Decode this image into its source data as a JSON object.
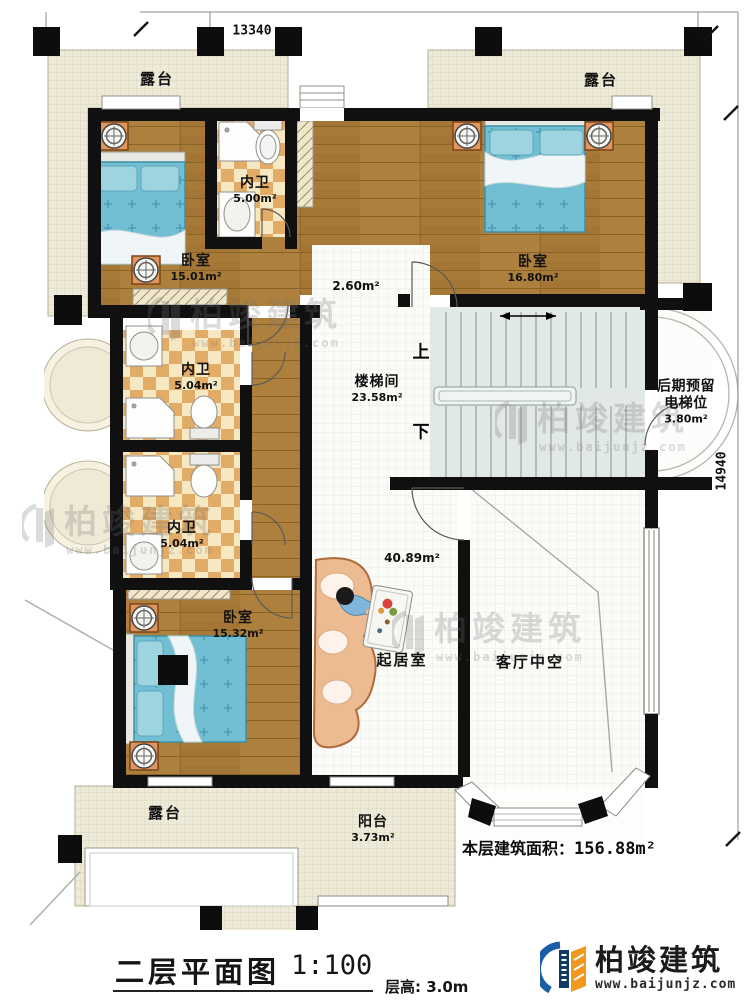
{
  "dimensions": {
    "top": "13340",
    "right": "14940"
  },
  "rooms": {
    "terrace_tl": {
      "label": "露台"
    },
    "terrace_tr": {
      "label": "露台"
    },
    "terrace_bl": {
      "label": "露台"
    },
    "balcony": {
      "label": "阳台",
      "area": "3.73m²"
    },
    "bath_top": {
      "label": "内卫",
      "area": "5.00m²"
    },
    "bath_mid": {
      "label": "内卫",
      "area": "5.04m²"
    },
    "bath_low": {
      "label": "内卫",
      "area": "5.04m²"
    },
    "bedroom_tl": {
      "label": "卧室",
      "area": "15.01m²"
    },
    "bedroom_tr": {
      "label": "卧室",
      "area": "16.80m²"
    },
    "bedroom_bl": {
      "label": "卧室",
      "area": "15.32m²"
    },
    "hall": {
      "area": "2.60m²"
    },
    "stairwell": {
      "label": "楼梯间",
      "area": "23.58m²"
    },
    "elevator": {
      "label_line1": "后期预留",
      "label_line2": "电梯位",
      "area": "3.80m²"
    },
    "living": {
      "label": "起居室",
      "area": "40.89m²"
    },
    "void": {
      "label": "客厅中空"
    }
  },
  "stairs": {
    "up": "上",
    "down": "下"
  },
  "area_note": {
    "label": "本层建筑面积：",
    "value": "156.88m²"
  },
  "title_block": {
    "title": "二层平面图",
    "scale": "1:100",
    "floor_height": "层高: 3.0m"
  },
  "logo": {
    "name": "柏竣建筑",
    "website": "www.baijunjz.com"
  },
  "watermark": {
    "text": "柏竣建筑",
    "url": "www.baijunjz.com"
  },
  "colors": {
    "wall": "#111111",
    "wood": "#a87a37",
    "terrace": "#edead9",
    "checker": "#e2ab66",
    "bed_blue": "#72bfd3",
    "stair_gray": "#e2e8e5",
    "logo_blue": "#1a5fa5",
    "logo_orange": "#f2991d",
    "logo_navy": "#123a63"
  }
}
